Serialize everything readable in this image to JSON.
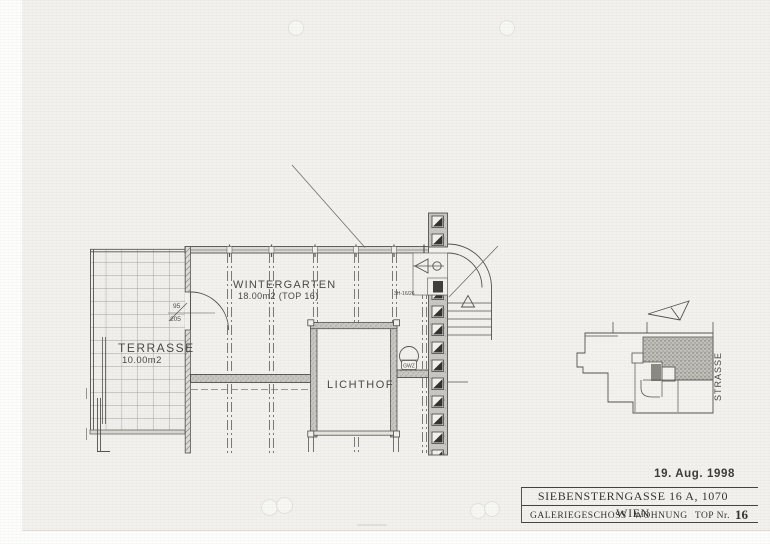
{
  "plan": {
    "rooms": {
      "wintergarten": {
        "name": "WINTERGARTEN",
        "area": "18.00m2 (TOP 16)"
      },
      "terrasse": {
        "name": "TERRASSE",
        "area": "10.00m2"
      },
      "lichthof": {
        "name": "LICHTHOF"
      }
    },
    "annotations": {
      "door_width": "95",
      "door_height": "205",
      "stair_note": "3H-16/26",
      "fixture": "GWZ"
    }
  },
  "site_plan": {
    "street_label": "STRASSE"
  },
  "stamp": {
    "date": "19. Aug. 1998"
  },
  "title_block": {
    "address": "SIEBENSTERNGASSE 16 A, 1070 WIEN",
    "floor": "GALERIEGESCHOSS",
    "unit_type": "WOHNUNG",
    "unit_label": "TOP Nr.",
    "unit_number": "16"
  },
  "colors": {
    "paper": "#f2f1ed",
    "ink": "#55534e",
    "wall_fill": "#c6c5c0"
  }
}
